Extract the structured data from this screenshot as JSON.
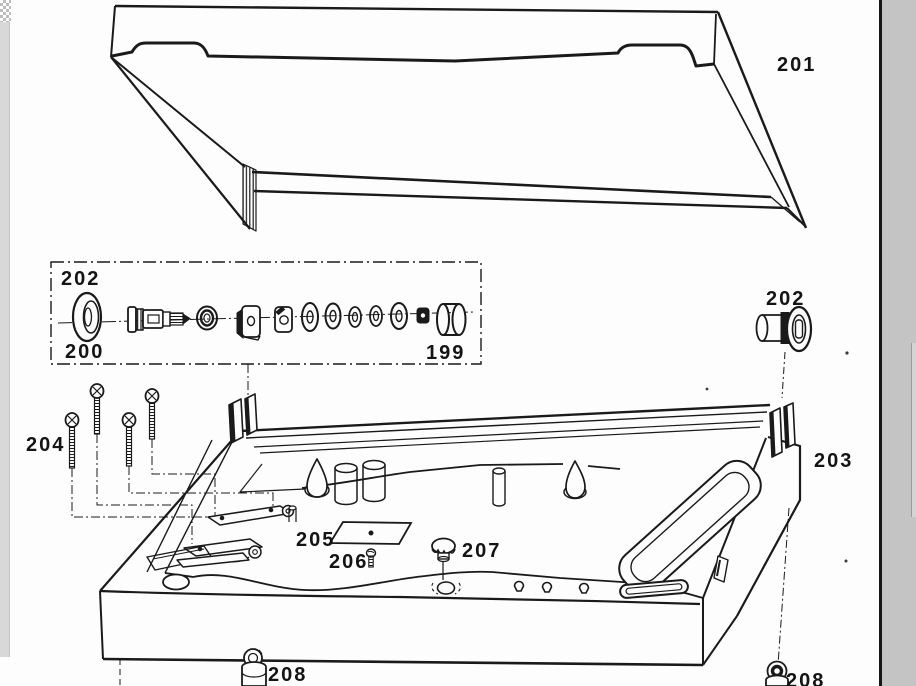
{
  "page": {
    "type": "exploded-parts-diagram-scan",
    "paper_color": "#fdfdfd",
    "ink_color": "#1a1a1a",
    "scroll_track_color": "#c4c4c4",
    "margin_strip_color": "#d8d8d8"
  },
  "labels": {
    "cover": "201",
    "hinge_box": "202",
    "grommet": "200",
    "sleeve": "199",
    "hinge_right": "202",
    "chassis": "203",
    "screws": "204",
    "plate": "205",
    "plate_screw": "206",
    "knob": "207",
    "foot_left": "208",
    "foot_right": "208"
  }
}
